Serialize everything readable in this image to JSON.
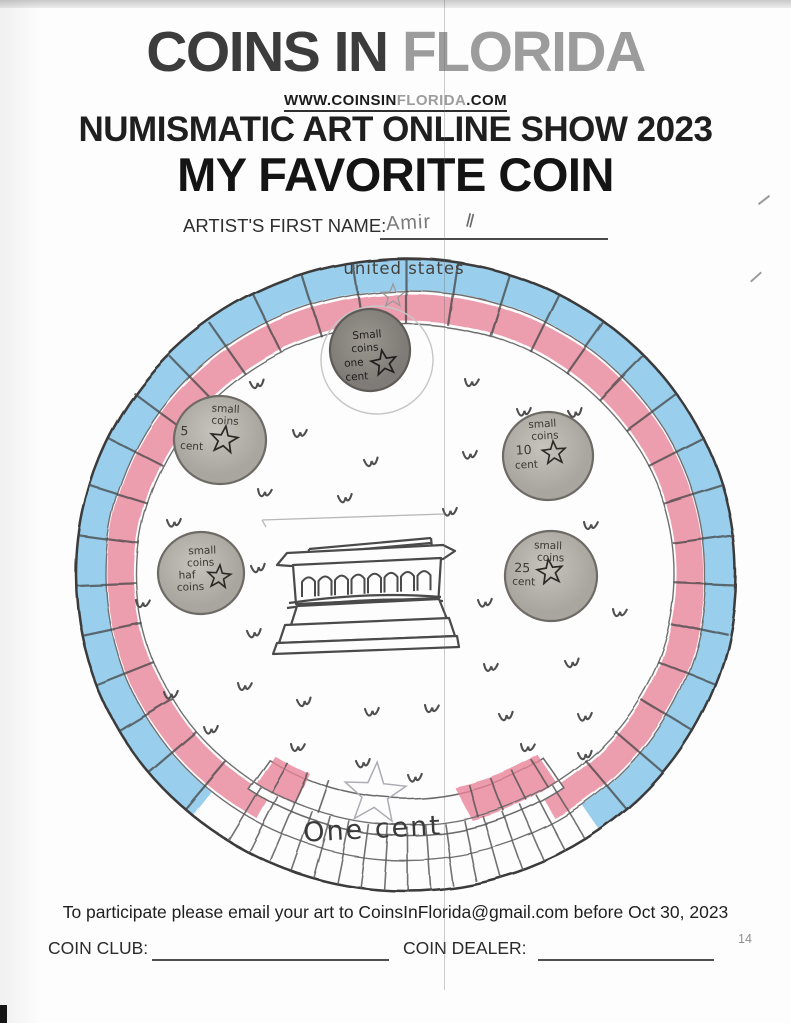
{
  "header": {
    "title_dark": "COINS IN ",
    "title_light": "FLORIDA",
    "url_p1": "WWW.COINSIN",
    "url_p2": "FLORIDA",
    "url_p3": ".COM",
    "subtitle": "NUMISMATIC ART ONLINE SHOW 2023",
    "show_title": "MY FAVORITE COIN",
    "artist_label": "ARTIST'S FIRST NAME:",
    "artist_name": "Amir",
    "artist_marks": "ll"
  },
  "coin": {
    "top_legend": "united states",
    "bottom_legend": "One cent",
    "mini_coins": [
      {
        "l1": "Small",
        "l2": "coins",
        "l3": "one",
        "l4": "cent"
      },
      {
        "l1": "small",
        "l2": "coins",
        "l3": "5",
        "l4": "cent"
      },
      {
        "l1": "small",
        "l2": "coins",
        "l3": "10",
        "l4": "cent"
      },
      {
        "l1": "small",
        "l2": "coins",
        "l3": "haf",
        "l4": "coins"
      },
      {
        "l1": "small",
        "l2": "coins",
        "l3": "25",
        "l4": "cent"
      }
    ]
  },
  "footer": {
    "email_line": "To participate please email your art to CoinsInFlorida@gmail.com before Oct 30, 2023",
    "coin_club_label": "COIN CLUB:",
    "coin_dealer_label": "COIN DEALER:",
    "page_number": "14"
  },
  "colors": {
    "crayon_blue": "#7fc2e9",
    "crayon_red": "#e8839a",
    "pencil": "#4a4a4a"
  }
}
